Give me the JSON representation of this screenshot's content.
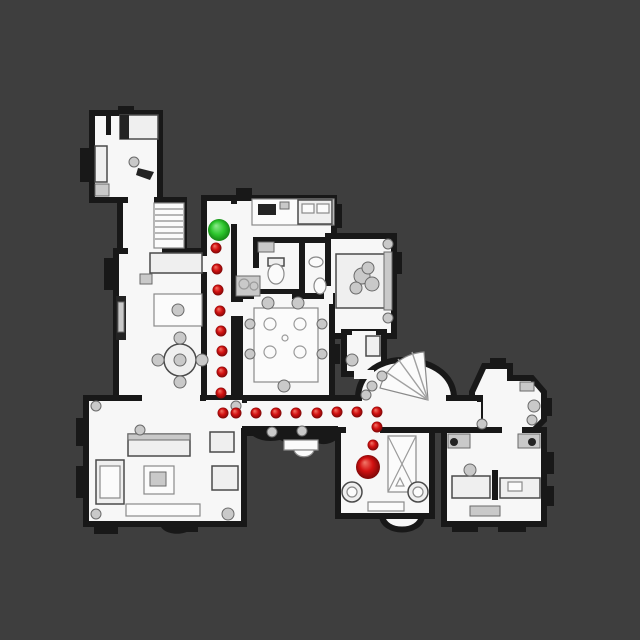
{
  "scene": {
    "type": "top-down floor plan navigation map",
    "background_color": "#3e3e3e",
    "floor_color": "#f7f7f7",
    "wall_color": "#181818",
    "legend": {
      "start_marker": "green sphere - path start",
      "waypoint_dots": "small red spheres - navigation path",
      "goal_marker": "large red sphere - path goal"
    }
  },
  "markers": {
    "start": {
      "x": 219,
      "y": 230,
      "r": 11
    },
    "goal": {
      "x": 368,
      "y": 467,
      "r": 12
    },
    "waypoint_r": 5.5,
    "waypoints": [
      [
        216,
        248
      ],
      [
        217,
        269
      ],
      [
        218,
        290
      ],
      [
        220,
        311
      ],
      [
        221,
        331
      ],
      [
        222,
        351
      ],
      [
        222,
        372
      ],
      [
        221,
        393
      ],
      [
        223,
        413
      ],
      [
        236,
        413
      ],
      [
        256,
        413
      ],
      [
        276,
        413
      ],
      [
        296,
        413
      ],
      [
        317,
        413
      ],
      [
        337,
        412
      ],
      [
        357,
        412
      ],
      [
        377,
        412
      ],
      [
        377,
        427
      ],
      [
        373,
        445
      ]
    ],
    "colors": {
      "start_hi": "#8fe98f",
      "start_mid": "#2dc72d",
      "start_edge": "#0f7a0f",
      "red_hi": "#f2796a",
      "red_mid": "#d31111",
      "red_edge": "#6f0606"
    }
  }
}
